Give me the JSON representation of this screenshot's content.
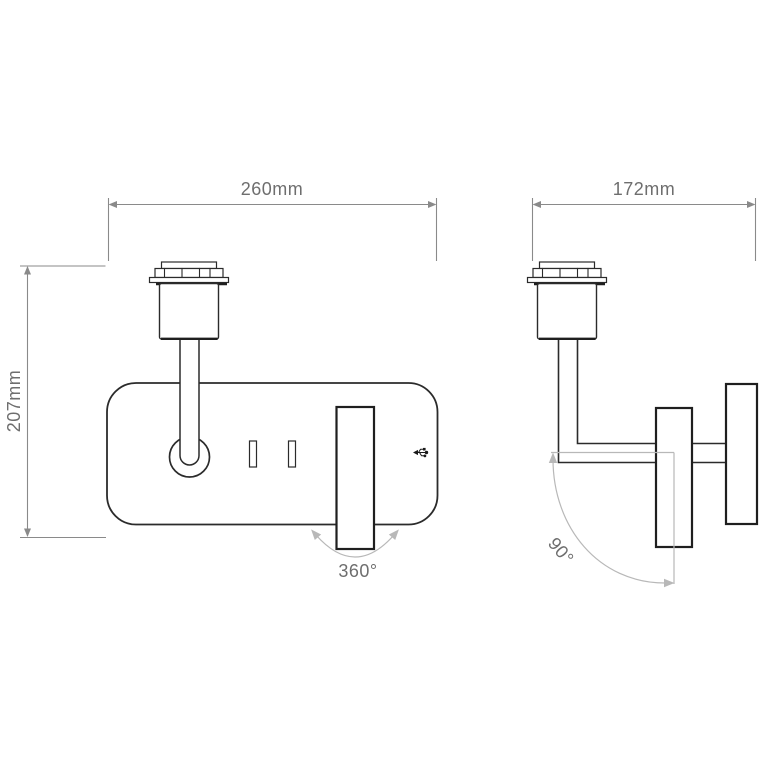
{
  "drawing": {
    "type": "technical-dimension-drawing",
    "subject": "wall light with rotatable reading spot and USB port, front and side elevation",
    "front_view": {
      "width_dimension": "260mm",
      "height_dimension": "207mm",
      "rotation_annotation": "360°"
    },
    "side_view": {
      "depth_dimension": "172mm",
      "rotation_annotation": "90°"
    },
    "icons": {
      "usb_port": "usb-icon"
    },
    "colors": {
      "background": "#ffffff",
      "outline": "#2b2b2b",
      "outline_heavy": "#1f1f1f",
      "dimension_line": "#8a8a8a",
      "annotation_line": "#b8b8b8",
      "dimension_text": "#6e6e6e",
      "icon": "#1a1a1a"
    }
  }
}
